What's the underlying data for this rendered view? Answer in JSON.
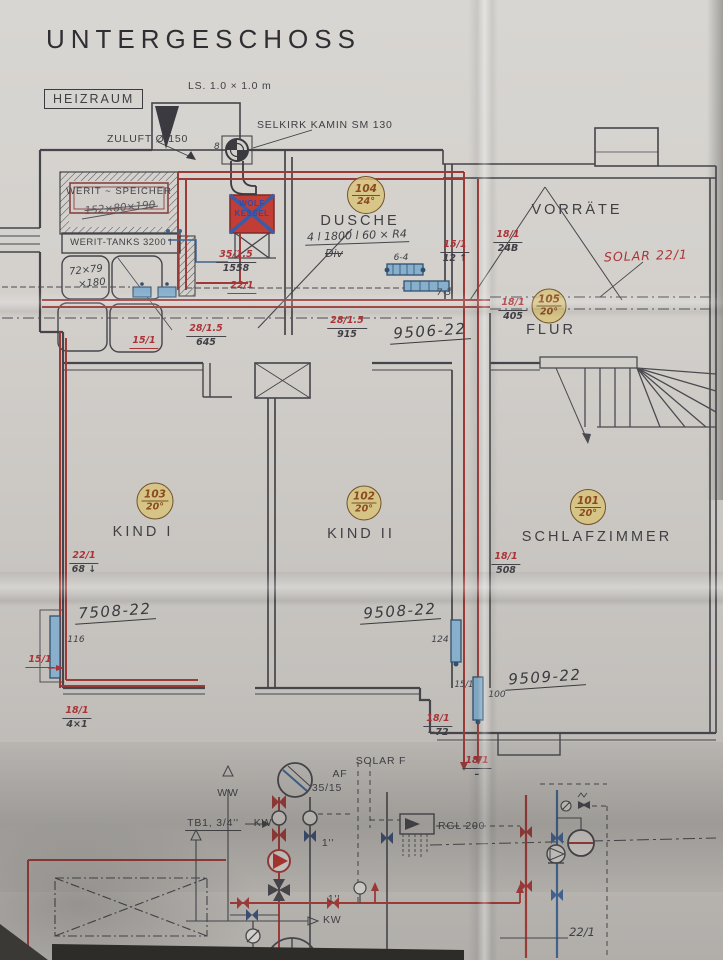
{
  "title": "UNTERGESCHOSS",
  "labels": {
    "heizraum": "HEIZRAUM",
    "ls": "LS. 1.0 × 1.0 m",
    "selkirk": "SELKIRK KAMIN SM 130",
    "zuluft": "ZULUFT Ø 150",
    "flue_size": "8",
    "werit_speicher": "WERIT ~ SPEICHER",
    "speicher_dims": "152×80×190",
    "werit_tanks": "WERIT-TANKS 3200 l",
    "tank_dims_1": "72×79",
    "tank_dims_2": "×180",
    "wolf_1": "WOLF",
    "wolf_2": "KESSEL",
    "solar": "SOLAR 22/1"
  },
  "rooms": {
    "dusche": {
      "name": "DUSCHE",
      "number": "104",
      "temp": "24°",
      "note": "4 l 1800 l 60 × R4",
      "note2": "Div"
    },
    "vorraete": {
      "name": "VORRÄTE"
    },
    "flur": {
      "name": "FLUR",
      "number": "105",
      "temp": "20°"
    },
    "kind1": {
      "name": "KIND I",
      "number": "103",
      "temp": "20°"
    },
    "kind2": {
      "name": "KIND II",
      "number": "102",
      "temp": "20°"
    },
    "schlafzimmer": {
      "name": "SCHLAFZIMMER",
      "number": "101",
      "temp": "20°"
    }
  },
  "drawing_refs": {
    "r9506": "9506-22",
    "r7508": "7508-22",
    "r9508": "9508-22",
    "r9509": "9509-22"
  },
  "pipe_annotations": {
    "k1": {
      "red": "35/1.5",
      "black": "1558"
    },
    "k2": {
      "red": "22/1"
    },
    "k3": {
      "red": "28/1.5",
      "black": "645"
    },
    "k4": {
      "red": "15/1"
    },
    "k5": {
      "red": "28/1.5",
      "black": "915"
    },
    "k6": {
      "red": "15/1",
      "black": "12 ↑"
    },
    "k7": {
      "red": "18/1",
      "black": "24B"
    },
    "k8": {
      "red": "18/1",
      "black": "405"
    },
    "k9": {
      "red": "22/1",
      "black": "68 ↓"
    },
    "k10": {
      "red": "18/1",
      "black": "508"
    },
    "k11": {
      "red": "15/1"
    },
    "k12": {
      "red": "18/1",
      "black": "4×1"
    },
    "k13": {
      "red": "18/1",
      "black": "~72"
    },
    "k14": {
      "red": "18/1",
      "black": "–"
    }
  },
  "small_labels": {
    "rad_64": "6-4",
    "rad_73": "7-3",
    "rad_116": "116",
    "rad_124": "124",
    "rad_151": "15/1",
    "rad_100": "100"
  },
  "schematic": {
    "solar_f": "SOLAR F",
    "af": "AF",
    "dim_35_15": "35/15",
    "ww": "WW",
    "tb1": "TB1, 3/4''",
    "kw": "KW",
    "kw2": "KW",
    "inch_1": "1''",
    "inch_1b": "1''",
    "rgl": "RGL 200",
    "v22_1": "22/1"
  },
  "colors": {
    "pipe_red": "#9c3a38",
    "annotation_red": "#ab3337",
    "ink": "#45454b",
    "blue": "#41628e",
    "stamp_fill": "#d6be78",
    "stamp_text": "#8a4a1f"
  }
}
